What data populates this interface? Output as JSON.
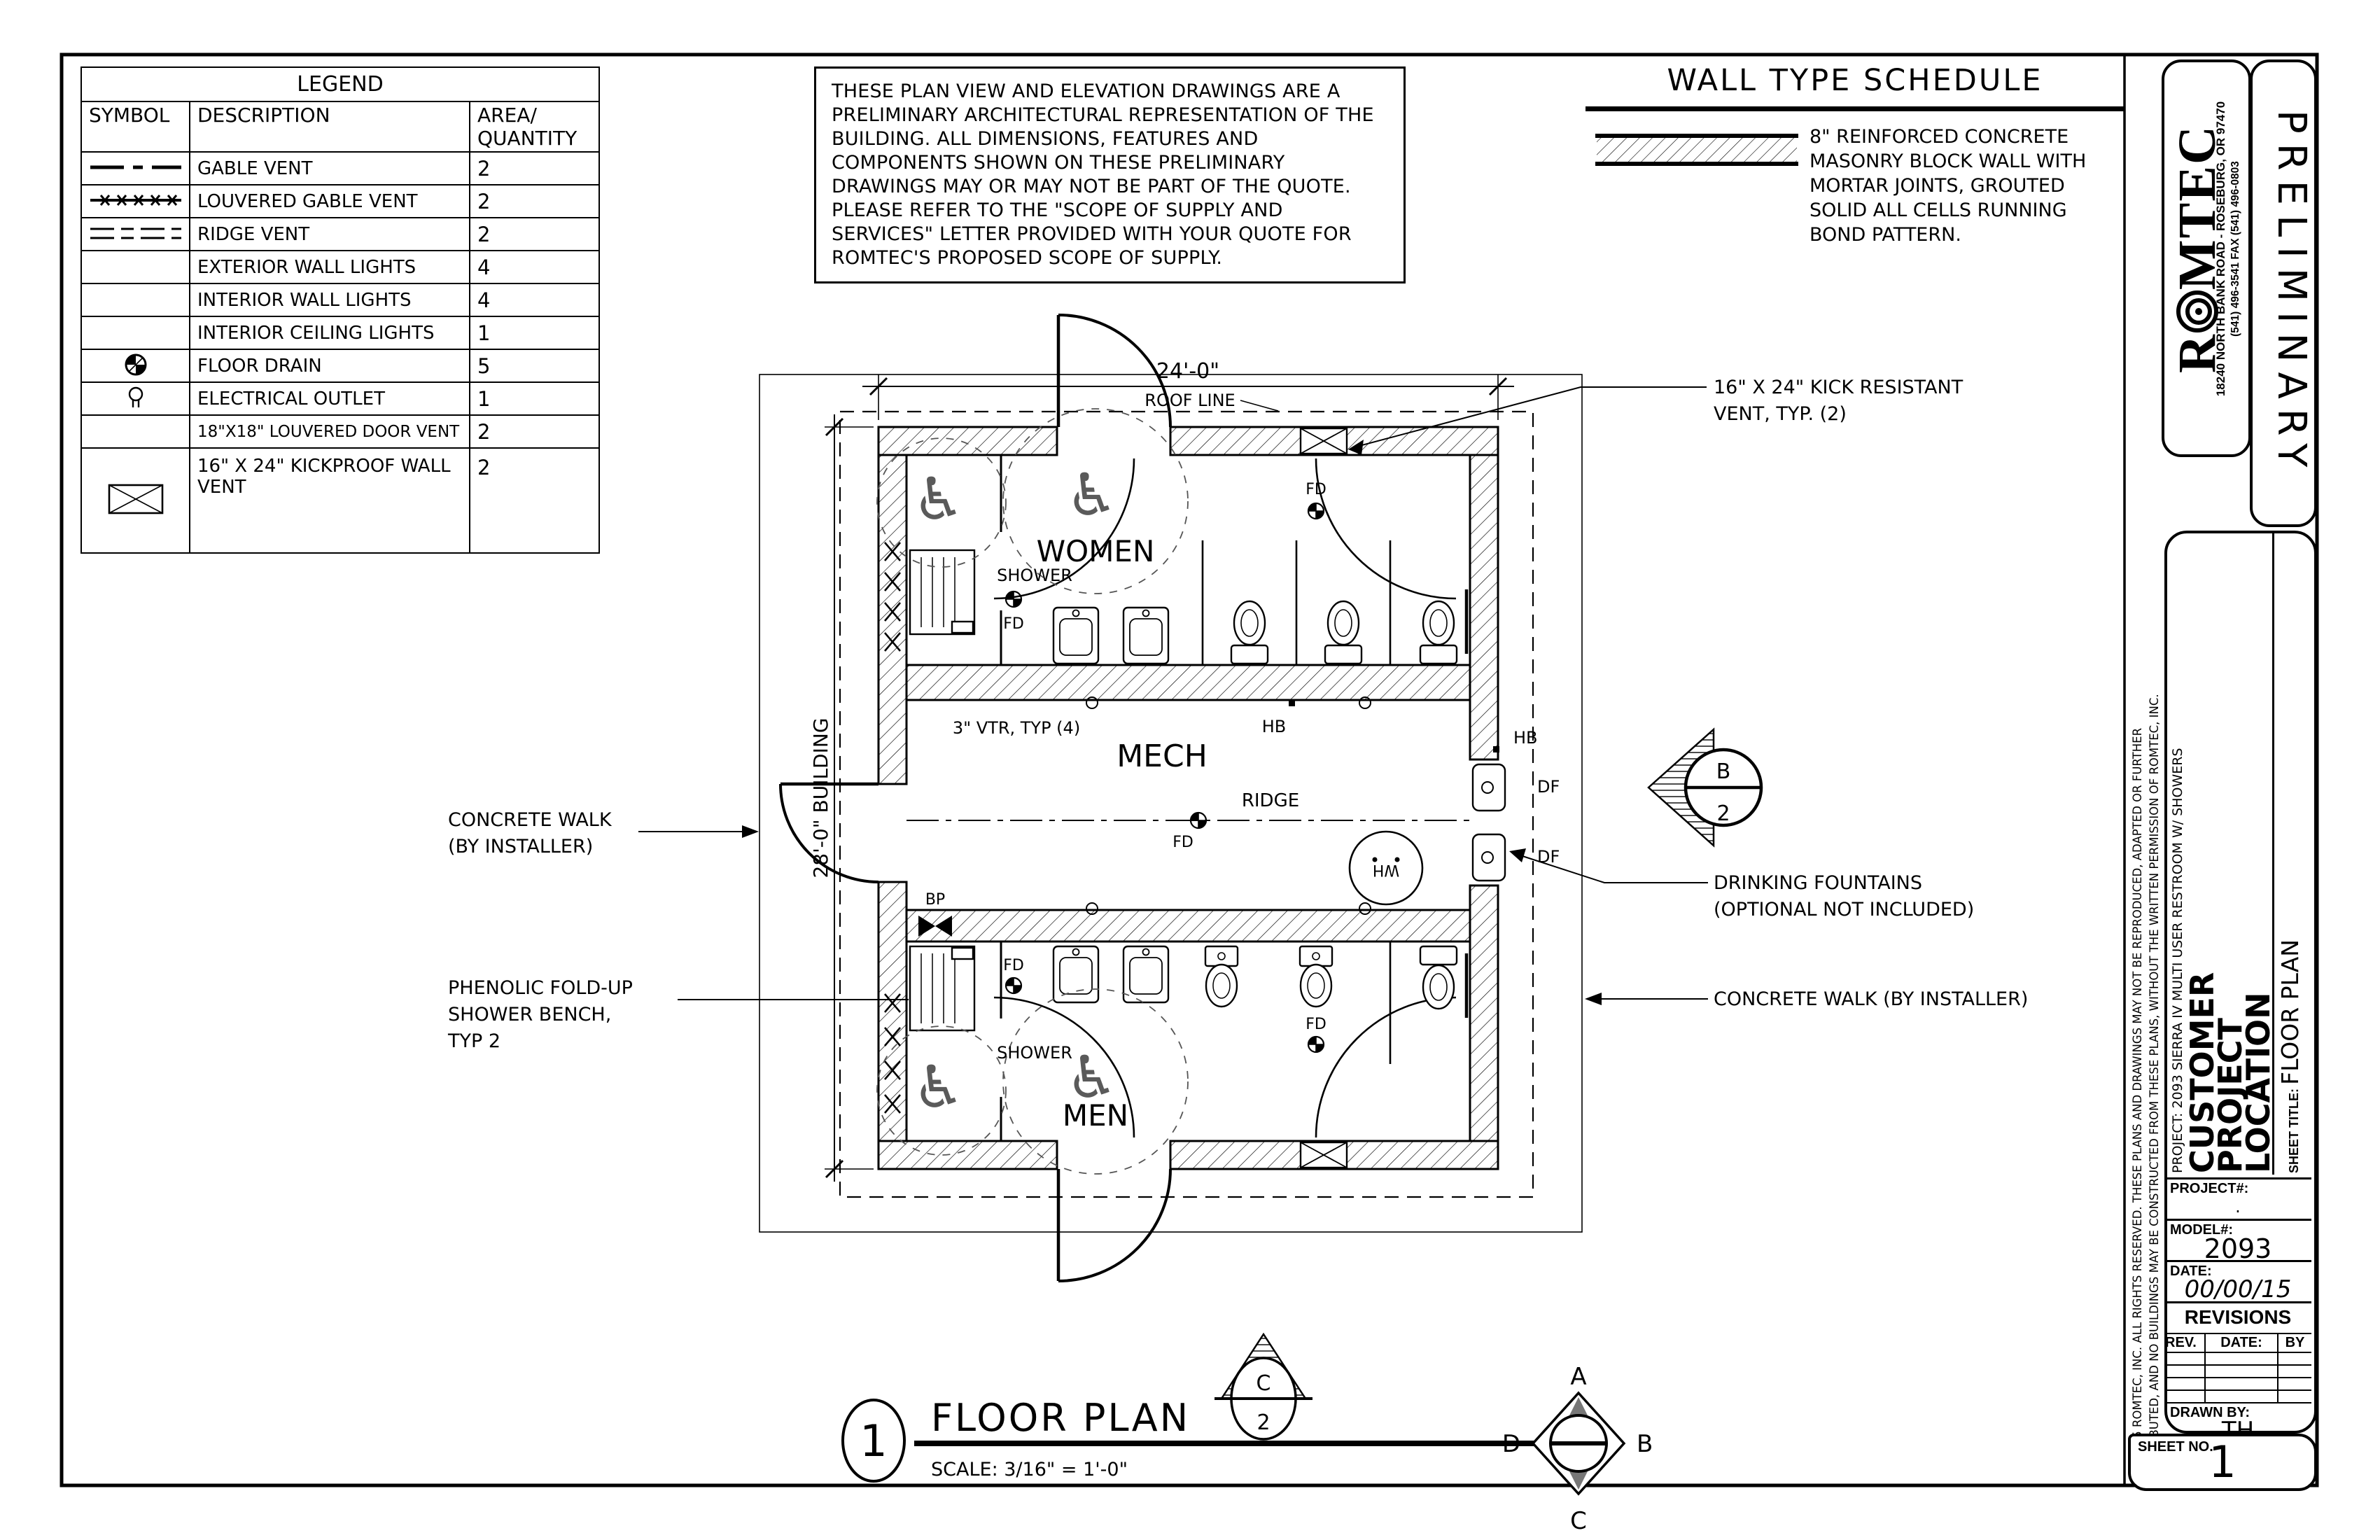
{
  "legend": {
    "title": "LEGEND",
    "col_symbol": "SYMBOL",
    "col_description": "DESCRIPTION",
    "col_area": "AREA/",
    "col_quantity": "QUANTITY",
    "rows": [
      {
        "icon": "gable-vent-line",
        "description": "GABLE VENT",
        "quantity": "2"
      },
      {
        "icon": "louvered-gable-vent-line",
        "description": "LOUVERED GABLE VENT",
        "quantity": "2"
      },
      {
        "icon": "ridge-vent-line",
        "description": "RIDGE VENT",
        "quantity": "2"
      },
      {
        "icon": "none",
        "description": "EXTERIOR WALL LIGHTS",
        "quantity": "4"
      },
      {
        "icon": "none",
        "description": "INTERIOR WALL LIGHTS",
        "quantity": "4"
      },
      {
        "icon": "none",
        "description": "INTERIOR CEILING LIGHTS",
        "quantity": "1"
      },
      {
        "icon": "floor-drain",
        "description": "FLOOR DRAIN",
        "quantity": "5"
      },
      {
        "icon": "electrical-outlet",
        "description": "ELECTRICAL OUTLET",
        "quantity": "1"
      },
      {
        "icon": "none",
        "description": "18\"X18\" LOUVERED DOOR VENT",
        "quantity": "2"
      },
      {
        "icon": "kickproof-wall-vent",
        "description": "16\" X 24\" KICKPROOF WALL VENT",
        "quantity": "2"
      }
    ]
  },
  "notes": {
    "text": "THESE PLAN VIEW AND ELEVATION DRAWINGS ARE A PRELIMINARY ARCHITECTURAL REPRESENTATION OF THE BUILDING. ALL DIMENSIONS, FEATURES AND COMPONENTS SHOWN ON THESE PRELIMINARY DRAWINGS MAY OR MAY NOT BE PART OF THE QUOTE. PLEASE REFER TO THE \"SCOPE OF SUPPLY AND SERVICES\" LETTER PROVIDED WITH YOUR QUOTE FOR ROMTEC'S PROPOSED SCOPE OF SUPPLY."
  },
  "wall_type_schedule": {
    "title": "WALL TYPE SCHEDULE",
    "description": "8\" REINFORCED CONCRETE MASONRY BLOCK WALL WITH MORTAR JOINTS, GROUTED SOLID ALL CELLS RUNNING BOND PATTERN."
  },
  "plan": {
    "rooms": {
      "women": "WOMEN",
      "mech": "MECH",
      "men": "MEN"
    },
    "labels": {
      "shower": "SHOWER",
      "fd": "FD",
      "hb": "HB",
      "df": "DF",
      "wh": "WH",
      "bp": "BP",
      "ridge": "RIDGE",
      "vtr": "3\" VTR, TYP (4)",
      "roof_line": "ROOF LINE"
    },
    "icons": {
      "wheelchair": "♿"
    },
    "dimensions": {
      "width": "24'-0\"",
      "height": "28'-0\" BUILDING"
    }
  },
  "annotations": {
    "concrete_walk_left_1": "CONCRETE WALK",
    "concrete_walk_left_2": "(BY INSTALLER)",
    "shower_bench_1": "PHENOLIC FOLD-UP",
    "shower_bench_2": "SHOWER BENCH,",
    "shower_bench_3": "TYP 2",
    "kick_vent_1": "16\" X 24\" KICK RESISTANT",
    "kick_vent_2": "VENT, TYP. (2)",
    "drinking_fountains_1": "DRINKING FOUNTAINS",
    "drinking_fountains_2": "(OPTIONAL NOT INCLUDED)",
    "concrete_walk_right": "CONCRETE WALK (BY INSTALLER)"
  },
  "floor_plan_title": {
    "number": "1",
    "title": "FLOOR PLAN",
    "scale": "SCALE: 3/16\" = 1'-0\""
  },
  "markers": {
    "elevation": {
      "letter": "C",
      "number": "2"
    },
    "section": {
      "letter": "B",
      "number": "2"
    },
    "compass": {
      "top": "A",
      "right": "B",
      "bottom": "C",
      "left": "D"
    }
  },
  "title_block": {
    "logo_r": "R",
    "logo_rest": "MTEC",
    "address_line1": "18240 NORTH BANK ROAD - ROSEBURG, OR 97470",
    "address_line2": "(541) 496-3541    FAX (541) 496-0803",
    "preliminary": "PRELIMINARY",
    "copyright_line1": "© 2015 ROMTEC, INC.  ALL RIGHTS RESERVED.  THESE PLANS AND DRAWINGS MAY NOT BE REPRODUCED, ADAPTED OR FURTHER",
    "copyright_line2": "DISTRIBUTED, AND NO BUILDINGS MAY BE CONSTRUCTED FROM THESE PLANS, WITHOUT THE WRITTEN PERMISSION OF ROMTEC, INC.",
    "project_line": "PROJECT: 2093 SIERRA IV MULTI USER RESTROOM W/ SHOWERS",
    "customer_line1": "CUSTOMER",
    "customer_line2": "PROJECT",
    "customer_line3": "LOCATION",
    "sheet_title_label": "SHEET TITLE:",
    "sheet_title_value": "FLOOR PLAN",
    "project_no_label": "PROJECT#:",
    "project_no_value": ".",
    "model_label": "MODEL#:",
    "model_value": "2093",
    "date_label": "DATE:",
    "date_value": "00/00/15",
    "revisions_label": "REVISIONS",
    "rev_col": "REV.",
    "rev_date_col": "DATE:",
    "rev_by_col": "BY",
    "drawn_by_label": "DRAWN BY:",
    "drawn_by_value": "TH",
    "sheet_no_label": "SHEET NO.",
    "sheet_no_value": "1"
  }
}
